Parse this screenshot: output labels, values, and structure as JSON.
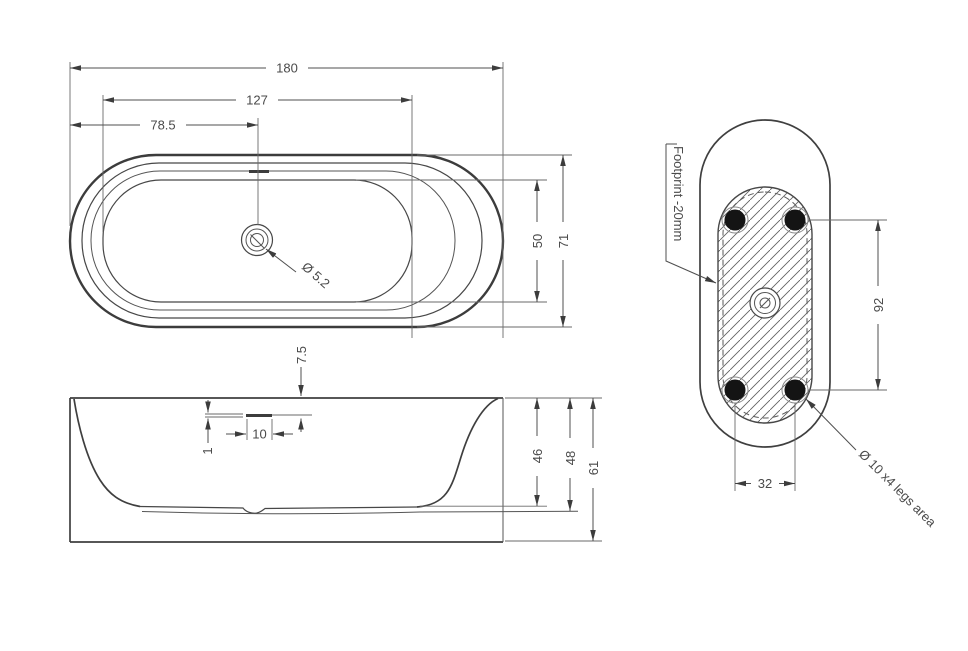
{
  "drawing": {
    "top_view": {
      "dims": {
        "overall_length": "180",
        "basin_length": "127",
        "drain_offset": "78.5",
        "basin_width": "50",
        "overall_width": "71",
        "drain_diameter": "Ø 5.2"
      }
    },
    "side_view": {
      "dims": {
        "rim_to_slot": "7.5",
        "slot_thickness": "1",
        "slot_length": "10",
        "inner_depth": "46",
        "shell_depth": "48",
        "overall_height": "61"
      }
    },
    "footprint_view": {
      "label": "Footprint -20mm",
      "legs_label": "Ø 10 x4 legs area",
      "dims": {
        "legs_pitch_long": "92",
        "legs_pitch_short": "32"
      }
    }
  }
}
